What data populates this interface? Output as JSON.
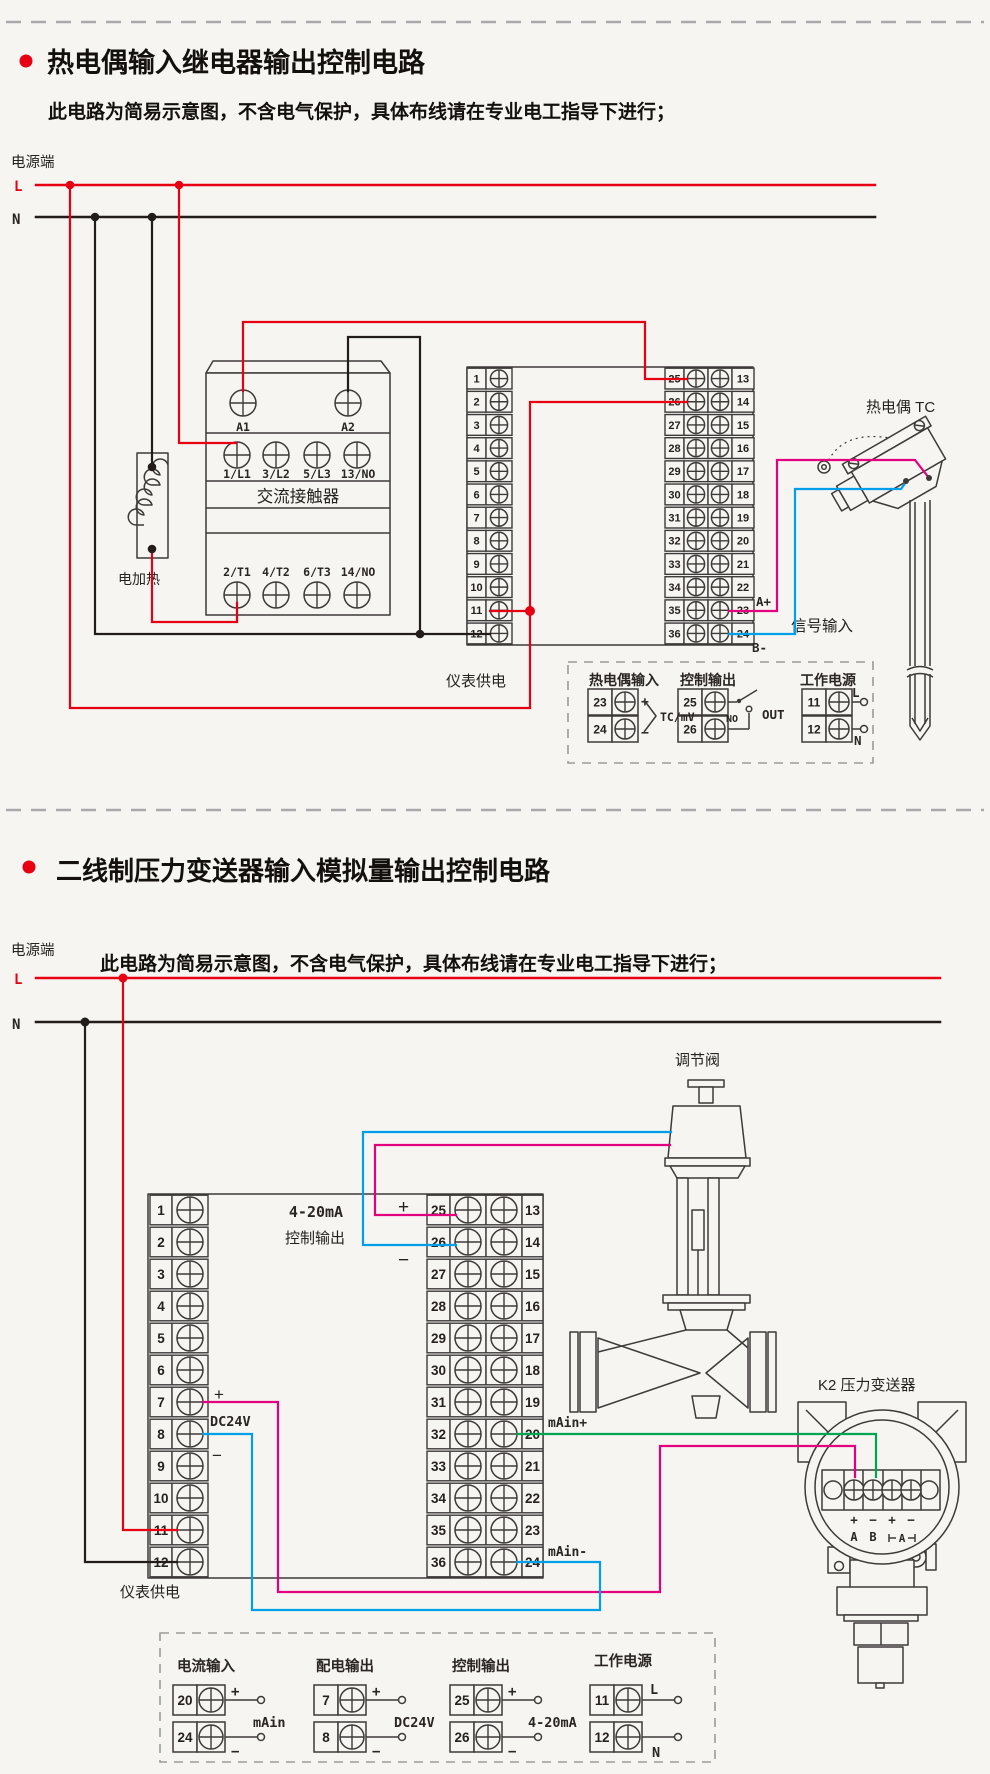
{
  "colors": {
    "background": "#f6f5f2",
    "accent_red": "#e60012",
    "wire_black": "#221d1b",
    "wire_magenta": "#e3007f",
    "wire_cyan": "#00a0e9",
    "wire_green": "#00a551",
    "outline": "#3e3a39"
  },
  "terminal_numbers": {
    "left": [
      "1",
      "2",
      "3",
      "4",
      "5",
      "6",
      "7",
      "8",
      "9",
      "10",
      "11",
      "12"
    ],
    "inner": [
      "25",
      "26",
      "27",
      "28",
      "29",
      "30",
      "31",
      "32",
      "33",
      "34",
      "35",
      "36"
    ],
    "outer": [
      "13",
      "14",
      "15",
      "16",
      "17",
      "18",
      "19",
      "20",
      "21",
      "22",
      "23",
      "24"
    ]
  },
  "section1": {
    "title": "热电偶输入继电器输出控制电路",
    "subtitle": "此电路为简易示意图，不含电气保护，具体布线请在专业电工指导下进行；",
    "power_terminal": "电源端",
    "l": "L",
    "n": "N",
    "contactor": {
      "name": "交流接触器",
      "a1": "A1",
      "a2": "A2",
      "row1": [
        "1/L1",
        "3/L2",
        "5/L3",
        "13/NO"
      ],
      "row2": [
        "2/T1",
        "4/T2",
        "6/T3",
        "14/NO"
      ]
    },
    "heater": "电加热",
    "meter_supply": "仪表供电",
    "signal_input": "信号输入",
    "a_plus": "A+",
    "b_minus": "B-",
    "tc": "热电偶 TC",
    "legend": {
      "tc_in": {
        "title": "热电偶输入",
        "rows": [
          "23",
          "24"
        ],
        "plus": "+",
        "minus": "−",
        "note": "TC/mV"
      },
      "ctrl": {
        "title": "控制输出",
        "rows": [
          "25",
          "26"
        ],
        "no": "NO",
        "out": "OUT"
      },
      "pwr": {
        "title": "工作电源",
        "rows": [
          "11",
          "12"
        ],
        "l": "L",
        "n": "N"
      }
    }
  },
  "section2": {
    "title": "二线制压力变送器输入模拟量输出控制电路",
    "subtitle": "此电路为简易示意图，不含电气保护，具体布线请在专业电工指导下进行；",
    "power_terminal": "电源端",
    "l": "L",
    "n": "N",
    "valve": "调节阀",
    "ctrl_out_line1": "4-20mA",
    "ctrl_out_line2": "控制输出",
    "ctrl_plus": "+",
    "ctrl_minus": "−",
    "dc_plus": "+",
    "dc_minus": "−",
    "dc": "DC24V",
    "main_in_plus": "mAin+",
    "main_in_minus": "mAin-",
    "meter_supply": "仪表供电",
    "transmitter": {
      "label": "K2 压力变送器",
      "p1": "+",
      "m1": "−",
      "p2": "+",
      "m2": "−",
      "a": "A",
      "b": "B",
      "a2": "A"
    },
    "legend": {
      "cur": {
        "title": "电流输入",
        "rows": [
          "20",
          "24"
        ],
        "plus": "+",
        "minus": "−",
        "note": "mAin"
      },
      "dist": {
        "title": "配电输出",
        "rows": [
          "7",
          "8"
        ],
        "plus": "+",
        "minus": "−",
        "note": "DC24V"
      },
      "ctrl": {
        "title": "控制输出",
        "rows": [
          "25",
          "26"
        ],
        "plus": "+",
        "minus": "−",
        "note": "4-20mA"
      },
      "pwr": {
        "title": "工作电源",
        "rows": [
          "11",
          "12"
        ],
        "l": "L",
        "n": "N"
      }
    }
  }
}
